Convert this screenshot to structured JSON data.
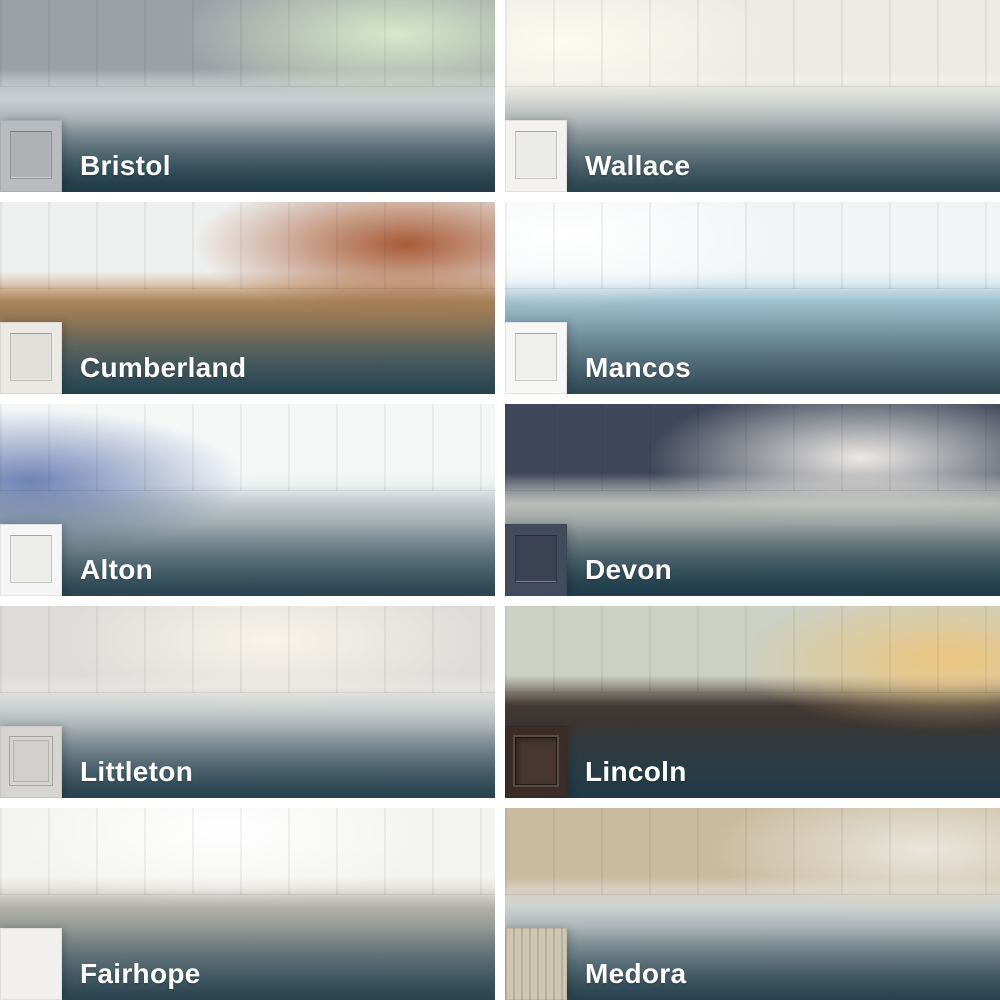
{
  "page": {
    "background_color": "#ffffff",
    "overlay_color": "#18333f",
    "label_text_color": "#ffffff"
  },
  "grid": {
    "columns": 2,
    "rows": 5,
    "gap_px": 10
  },
  "tiles": [
    {
      "name": "Bristol",
      "swatch": {
        "type": "shaker",
        "base": "#b9bcbf",
        "panel": "#aeb2b5"
      },
      "photo": {
        "desc": "gray shaker kitchen with blue-gray island and garden window",
        "wall": "#9ba2a7",
        "mid": "#e9ebeb",
        "floor": "#56747f",
        "accent": "#d8e8c8",
        "accent_pos": "80% 18%"
      }
    },
    {
      "name": "Wallace",
      "swatch": {
        "type": "shaker",
        "base": "#f3f2ef",
        "panel": "#ebebe8"
      },
      "photo": {
        "desc": "bright white kitchen with gold faucet and sunny window",
        "wall": "#eceae4",
        "mid": "#f6f4ee",
        "floor": "#8fa6ad",
        "accent": "#fdfaf0",
        "accent_pos": "12% 22%"
      }
    },
    {
      "name": "Cumberland",
      "swatch": {
        "type": "shaker",
        "base": "#ebe9e4",
        "panel": "#e2e0da"
      },
      "photo": {
        "desc": "white kitchen with brick wall, wood bar top and tan stools",
        "wall": "#eef0f0",
        "mid": "#c3935f",
        "floor": "#7599a1",
        "accent": "#a85c36",
        "accent_pos": "82% 22%"
      }
    },
    {
      "name": "Mancos",
      "swatch": {
        "type": "shaker",
        "base": "#f6f6f4",
        "panel": "#efefed"
      },
      "photo": {
        "desc": "white kitchen with aqua backsplash and blue pendant lights",
        "wall": "#f2f5f6",
        "mid": "#b7d9e8",
        "floor": "#a4bac6",
        "accent": "#ffffff",
        "accent_pos": "12% 18%"
      }
    },
    {
      "name": "Alton",
      "swatch": {
        "type": "shaker",
        "base": "#f4f5f4",
        "panel": "#ececeb"
      },
      "photo": {
        "desc": "white kitchen with patterned blue tile and wooden chairs",
        "wall": "#f5f6f6",
        "mid": "#dfe5e7",
        "floor": "#8aa5ad",
        "accent": "#6d83b5",
        "accent_pos": "6% 40%"
      }
    },
    {
      "name": "Devon",
      "swatch": {
        "type": "shaker",
        "base": "#434b5e",
        "panel": "#3a4254"
      },
      "photo": {
        "desc": "navy blue kitchen with white hood, subway tile and window seat",
        "wall": "#3f475a",
        "mid": "#d8d5cf",
        "floor": "#4b707d",
        "accent": "#ece9e4",
        "accent_pos": "72% 28%"
      }
    },
    {
      "name": "Littleton",
      "swatch": {
        "type": "thinline",
        "base": "#d7d5d2",
        "panel": "#d2d0cd"
      },
      "photo": {
        "desc": "light gray kitchen with glass pendants",
        "wall": "#dddcd9",
        "mid": "#f0efed",
        "floor": "#819aa6",
        "accent": "#f8f4ea",
        "accent_pos": "55% 18%"
      }
    },
    {
      "name": "Lincoln",
      "swatch": {
        "type": "raised",
        "base": "#3b2d26",
        "panel": "#473730"
      },
      "photo": {
        "desc": "espresso home office with gallery wall, desk and leather chair",
        "wall": "#cbd1c4",
        "mid": "#4a3931",
        "floor": "#46565c",
        "accent": "#ecc57e",
        "accent_pos": "90% 28%"
      }
    },
    {
      "name": "Fairhope",
      "swatch": {
        "type": "slab",
        "base": "#f1f0ee",
        "panel": "#f1f0ee"
      },
      "photo": {
        "desc": "greige flat-panel kitchen with wood island and bar stools",
        "wall": "#f3f3f1",
        "mid": "#ccc7bc",
        "floor": "#8ba0ab",
        "accent": "#ffffff",
        "accent_pos": "45% 12%"
      }
    },
    {
      "name": "Medora",
      "swatch": {
        "type": "woodgrain",
        "base": "#cfc6b2",
        "panel": "#b9ae97"
      },
      "photo": {
        "desc": "light oak kitchen with red pendants and cream stools",
        "wall": "#c9bb9f",
        "mid": "#edeeec",
        "floor": "#8097a3",
        "accent": "#eae6dc",
        "accent_pos": "85% 22%"
      }
    }
  ]
}
